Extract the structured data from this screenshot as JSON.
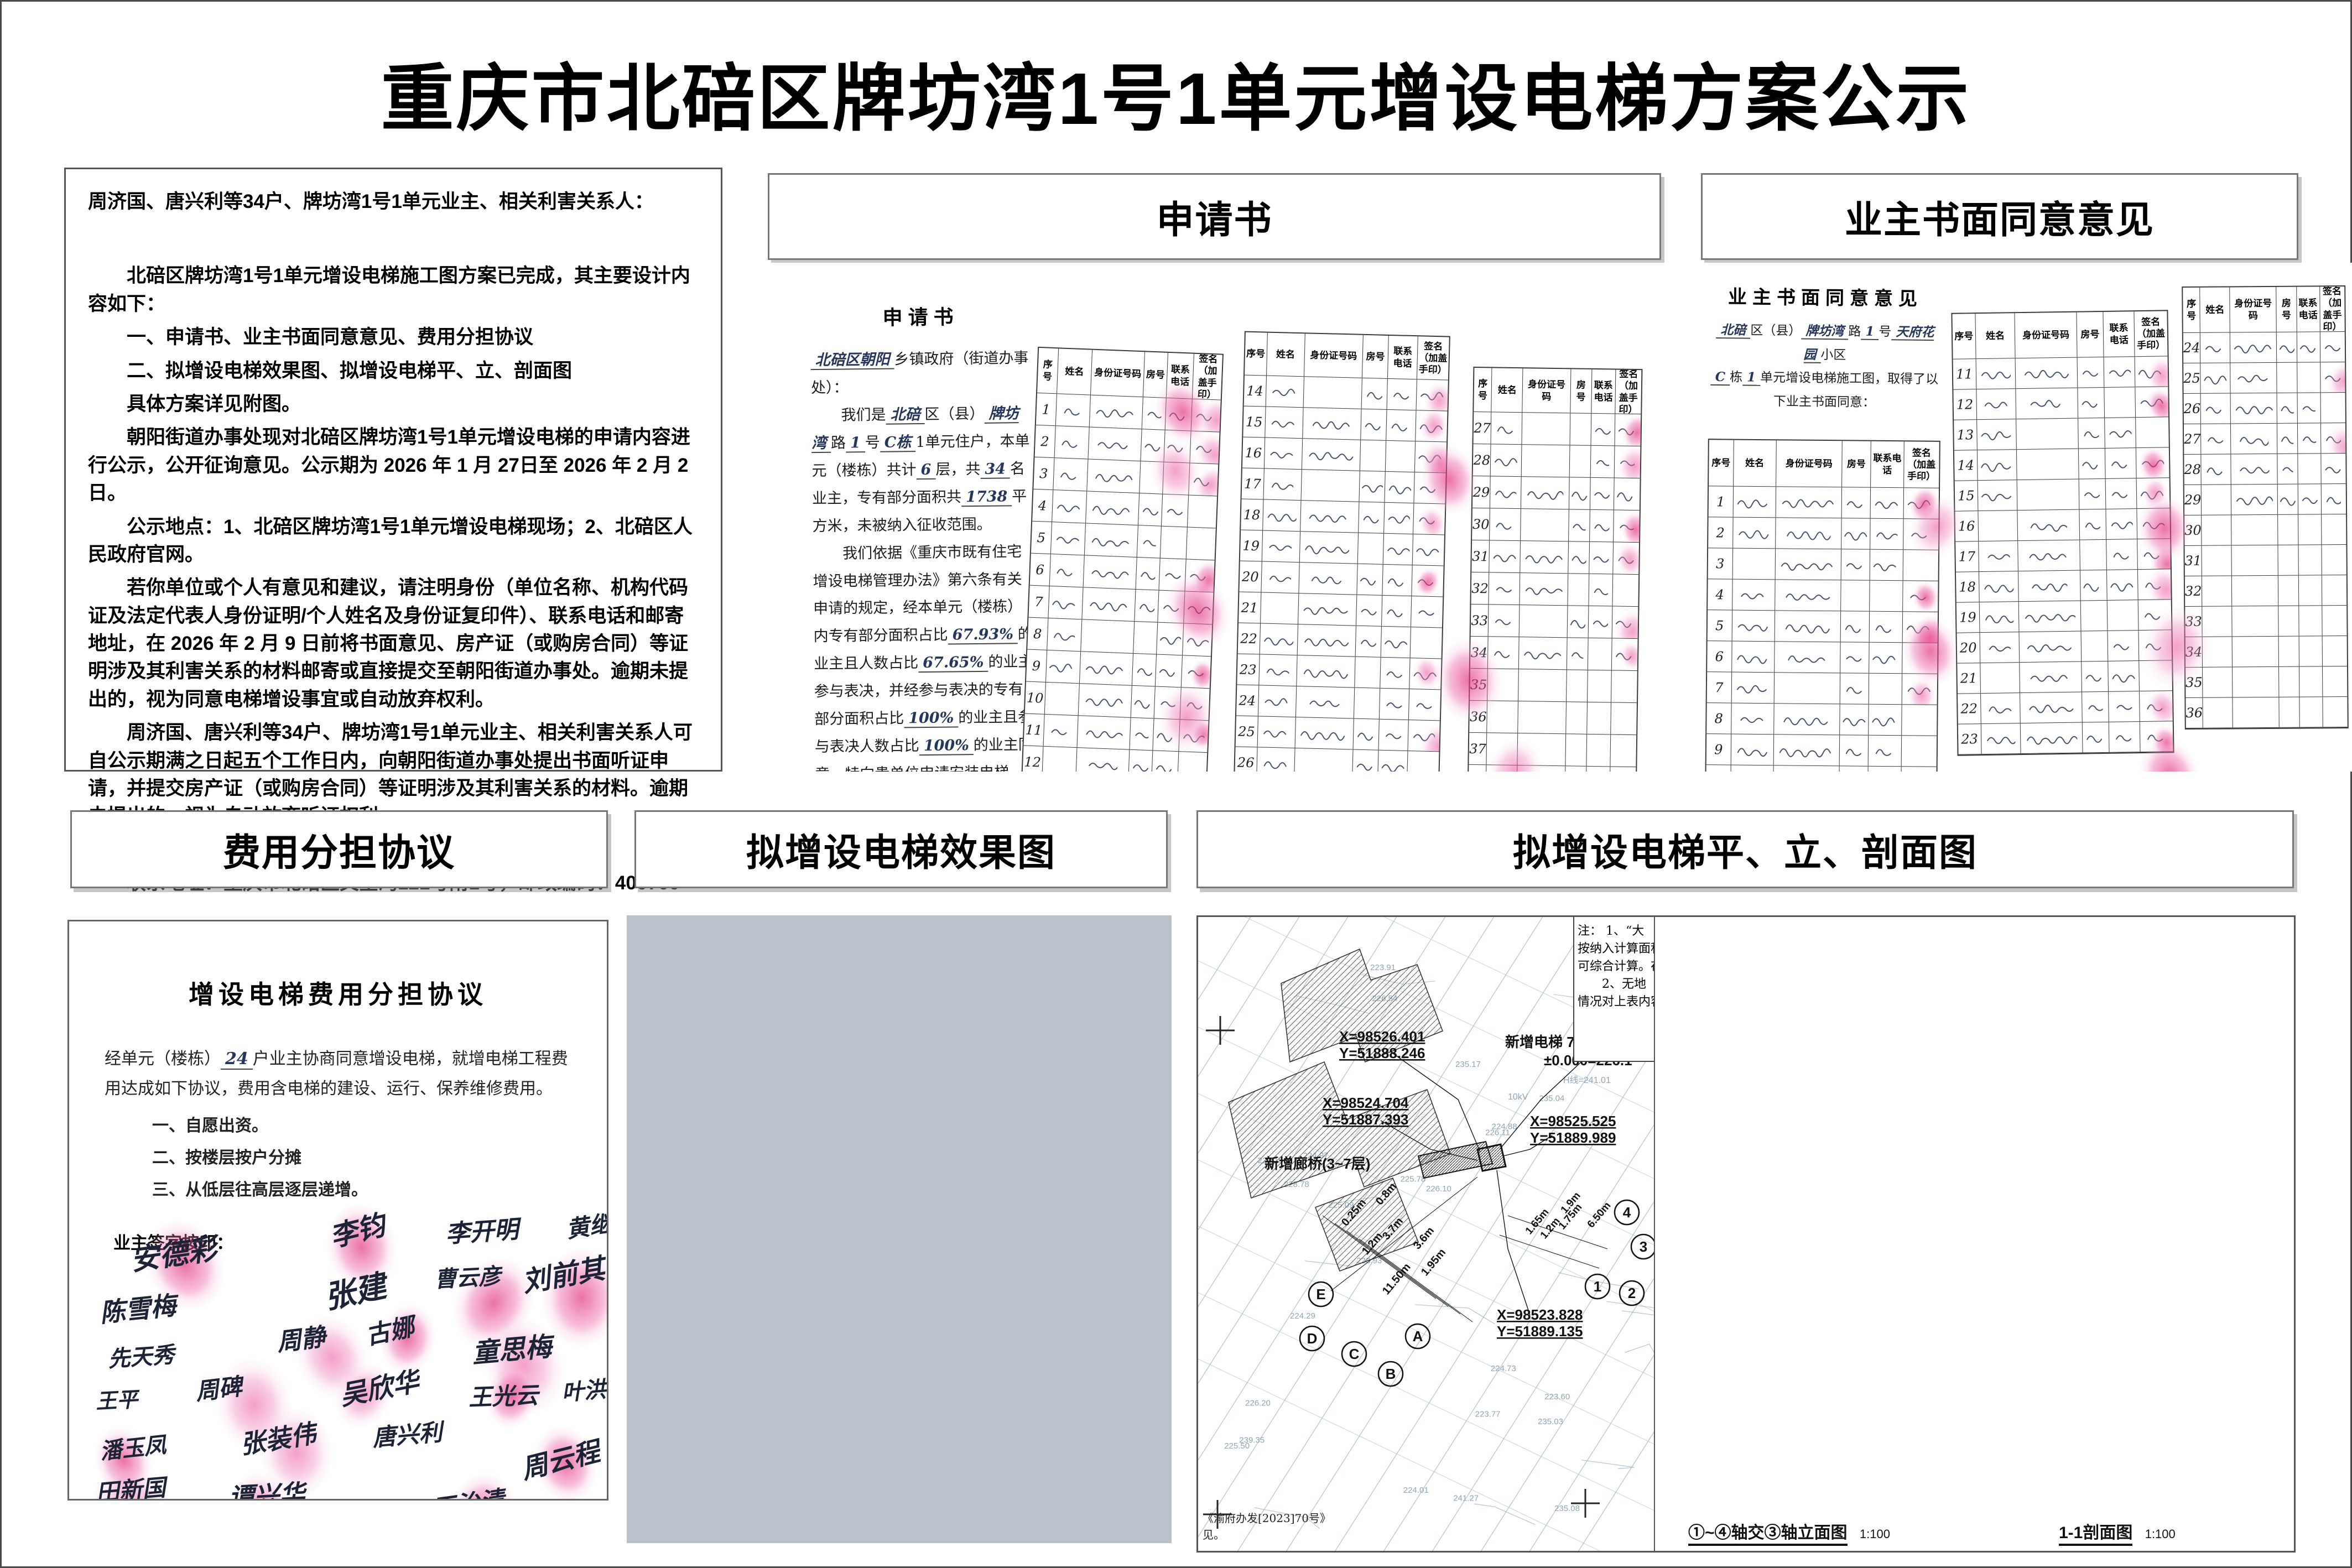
{
  "title": "重庆市北碚区牌坊湾1号1单元增设电梯方案公示",
  "colors": {
    "accent_red": "#e61e28",
    "wire_blue": "#4a63d8",
    "fingerprint_pink": "#e969ac",
    "ink_blue": "#26365a",
    "band_pink": "#c4837b",
    "gold": "#ab8a2e",
    "pepsi_blue": "#1e2a66"
  },
  "notice": {
    "paragraphs": [
      {
        "text": "周济国、唐兴利等34户、牌坊湾1号1单元业主、相关利害关系人：",
        "indent": false
      },
      {
        "text": "北碚区牌坊湾1号1单元增设电梯施工图方案已完成，其主要设计内容如下：",
        "indent": true
      },
      {
        "text": "一、申请书、业主书面同意意见、费用分担协议",
        "indent": true
      },
      {
        "text": "二、拟增设电梯效果图、拟增设电梯平、立、剖面图",
        "indent": true
      },
      {
        "text": "具体方案详见附图。",
        "indent": true
      },
      {
        "text": "朝阳街道办事处现对北碚区牌坊湾1号1单元增设电梯的申请内容进行公示，公开征询意见。公示期为 2026 年 1 月 27日至 2026 年 2 月 2 日。",
        "indent": true
      },
      {
        "text": "公示地点：1、北碚区牌坊湾1号1单元增设电梯现场；2、北碚区人民政府官网。",
        "indent": true
      },
      {
        "text": "若你单位或个人有意见和建议，请注明身份（单位名称、机构代码证及法定代表人身份证明/个人姓名及身份证复印件）、联系电话和邮寄地址，在 2026 年 2 月 9 日前将书面意见、房产证（或购房合同）等证明涉及其利害关系的材料邮寄或直接提交至朝阳街道办事处。逾期未提出的，视为同意电梯增设事宜或自动放弃权利。",
        "indent": true
      },
      {
        "text": "周济国、唐兴利等34户、牌坊湾1号1单元业主、相关利害关系人可自公示期满之日起五个工作日内，向朝阳街道办事处提出书面听证申请，并提交房产证（或购房合同）等证明涉及其利害关系的材料。逾期未提出的，视为自动放弃听证权利。",
        "indent": true
      },
      {
        "text": "联系人：刘老师，联系电话：023-68356461",
        "indent": true
      },
      {
        "text": "联系地址：重庆市北碚区文星湾121号附1号，邮政编码：400700",
        "indent": true
      }
    ]
  },
  "table_headers": [
    "序号",
    "姓名",
    "身份证号码",
    "房号",
    "联系电话",
    "签名（加盖手印）"
  ],
  "panels": {
    "application": {
      "header": "申请书",
      "doc_title": "申请书",
      "letter_lines": [
        [
          {
            "ink": "北碚区朝阳"
          },
          {
            "p": "乡镇政府（街道办事处）："
          }
        ],
        [
          {
            "p": "我们是"
          },
          {
            "ink": "北碚"
          },
          {
            "p": "区（县）"
          },
          {
            "ink": "牌坊湾"
          },
          {
            "p": "路"
          },
          {
            "ink": "1"
          },
          {
            "p": "号"
          },
          {
            "ink": "C栋"
          },
          {
            "p": "1单元住户，本单元（楼栋）共计"
          },
          {
            "ink": "6"
          },
          {
            "p": "层，共"
          },
          {
            "ink": "34"
          },
          {
            "p": "名业主，专有部分面积共"
          },
          {
            "ink": "1738"
          },
          {
            "p": "平方米，未被纳入征收范围。"
          }
        ],
        [
          {
            "p": "我们依据《重庆市既有住宅增设电梯管理办法》第六条有关申请的规定，经本单元（楼栋）内专有部分面积占比"
          },
          {
            "ink": "67.93%"
          },
          {
            "p": "的业主且人数占比"
          },
          {
            "ink": "67.65%"
          },
          {
            "p": "的业主参与表决，并经参与表决的专有部分面积占比"
          },
          {
            "ink": "100%"
          },
          {
            "p": "的业主且参与表决人数占比"
          },
          {
            "ink": "100%"
          },
          {
            "p": "的业主同意，特向贵单位申请安装电梯。"
          }
        ],
        [
          {
            "p": "特此申请。"
          }
        ],
        [
          {
            "p": "（申请人名单附后）"
          }
        ]
      ],
      "date_line": [
        {
          "ink": "11"
        },
        {
          "p": "月"
        },
        {
          "ink": "6"
        },
        {
          "p": "日"
        }
      ]
    },
    "consent": {
      "header": "业主书面同意意见",
      "doc_title": "业主书面同意意见",
      "intro_line1": [
        {
          "ink": "北碚"
        },
        {
          "p": "区（县）"
        },
        {
          "ink": "牌坊湾"
        },
        {
          "p": "路"
        },
        {
          "ink": "1"
        },
        {
          "p": "号"
        },
        {
          "ink": "天府花园"
        },
        {
          "p": "小区"
        }
      ],
      "intro_line2": [
        {
          "ink": "C"
        },
        {
          "p": "栋"
        },
        {
          "ink": "1"
        },
        {
          "p": "单元增设电梯施工图，取得了以下业主书面同意："
        }
      ]
    },
    "cost": {
      "header": "费用分担协议",
      "doc_title": "增设电梯费用分担协议",
      "body": [
        {
          "p": "经单元（楼栋）"
        },
        {
          "ink": "24"
        },
        {
          "p": "户业主协商同意增设电梯，就增电梯工程费用达成如下协议，费用含电梯的建设、运行、保养维修费用。"
        }
      ],
      "items": [
        "一、自愿出资。",
        "二、按楼层按户分摊",
        "三、从低层往高层逐层递增。"
      ],
      "sign_label": "业主签字按印：",
      "signatures": [
        "安德彩",
        "李钧",
        "李开明",
        "黄继华",
        "陈雪梅",
        "张建",
        "曹云彦",
        "刘前其",
        "先天秀",
        "周静",
        "古娜",
        "童思梅",
        "王平",
        "周碑",
        "吴欣华",
        "王光云",
        "叶洪清",
        "潘玉凤",
        "张装伟",
        "唐兴利",
        "周云程",
        "田新国",
        "谭兴华",
        "王治清"
      ]
    },
    "photo": {
      "header": "拟增设电梯效果图",
      "building_sign": "天府花园",
      "pepsi_text": "百事可乐"
    },
    "drawings": {
      "header": "拟增设电梯平、立、剖面图"
    }
  },
  "site_plan": {
    "coord_labels": [
      {
        "x": "X=98526.401",
        "y": "Y=51888.246"
      },
      {
        "x": "X=98524.704",
        "y": "Y=51887.393"
      },
      {
        "x": "X=98525.525",
        "y": "Y=51889.989"
      },
      {
        "x": "X=98523.828",
        "y": "Y=51889.135"
      }
    ],
    "elevator_label": "新增电梯 7F H=24.000",
    "datum_label": "±0.000=226.1",
    "corridor_label": "新增廊桥(3~7层)",
    "dims_left": [
      "0.25m",
      "0.8m",
      "3.7m",
      "3.6m",
      "1.2m",
      "1.95m",
      "11.50m"
    ],
    "dims_right": [
      "1.65m",
      "1.2m",
      "1.75m",
      "1.9m",
      "6.50m"
    ],
    "axis_letters": [
      "E",
      "D",
      "C",
      "B",
      "A"
    ],
    "axis_numbers": [
      "1",
      "2",
      "3",
      "4"
    ],
    "power_label": "10kV",
    "hline_label": "H线=241.01",
    "spot_elevations": [
      "223.60",
      "223.77",
      "223.91",
      "223.93",
      "224.01",
      "224.29",
      "224.47",
      "224.73",
      "224.88",
      "224.97",
      "225.09",
      "225.50",
      "225.78",
      "226.10",
      "226.11",
      "226.15",
      "226.20",
      "226.54",
      "228.78",
      "235.03",
      "235.04",
      "235.08",
      "235.17",
      "239.35",
      "241.27"
    ],
    "note_lines": [
      "注：  1、“大",
      "按纳入计算面积",
      "可综合计算。在",
      "　　2、无地",
      "情况对上表内容"
    ],
    "doc_ref_lines": [
      "《渝府办发[2023]70号》",
      "见。"
    ]
  },
  "elevations": {
    "levels": [
      {
        "value": "24.000",
        "floor": ""
      },
      {
        "value": "22.000",
        "floor": ""
      },
      {
        "value": "19.000",
        "floor": "7F"
      },
      {
        "value": "16.000",
        "floor": "6F"
      },
      {
        "value": "13.000",
        "floor": "5F"
      },
      {
        "value": "10.000",
        "floor": "4F"
      },
      {
        "value": "7.000",
        "floor": "3F"
      },
      {
        "value": "4.000",
        "floor": "2F"
      },
      {
        "value": "±0.000",
        "floor": "1F"
      }
    ],
    "base_level": "-1.250",
    "dim_chain": [
      "2000",
      "3000",
      "3000",
      "3000",
      "3000",
      "3000",
      "3000",
      "4000"
    ],
    "dim_total": "24000",
    "left_bottom_dims": [
      "1650",
      "1200",
      "1750",
      "1900"
    ],
    "left_bottom_total": "6500",
    "right_bottom_dims": [
      "1450",
      "800",
      "3700",
      "3300",
      "300",
      "1950"
    ],
    "right_bottom_total": "11500",
    "caption_left": "①~④轴交③轴立面图",
    "caption_right": "1-1剖面图",
    "scale": "1:100",
    "orig_building_label": "原建筑",
    "beam_top_label": "GL2",
    "beam_label": "GL1"
  }
}
